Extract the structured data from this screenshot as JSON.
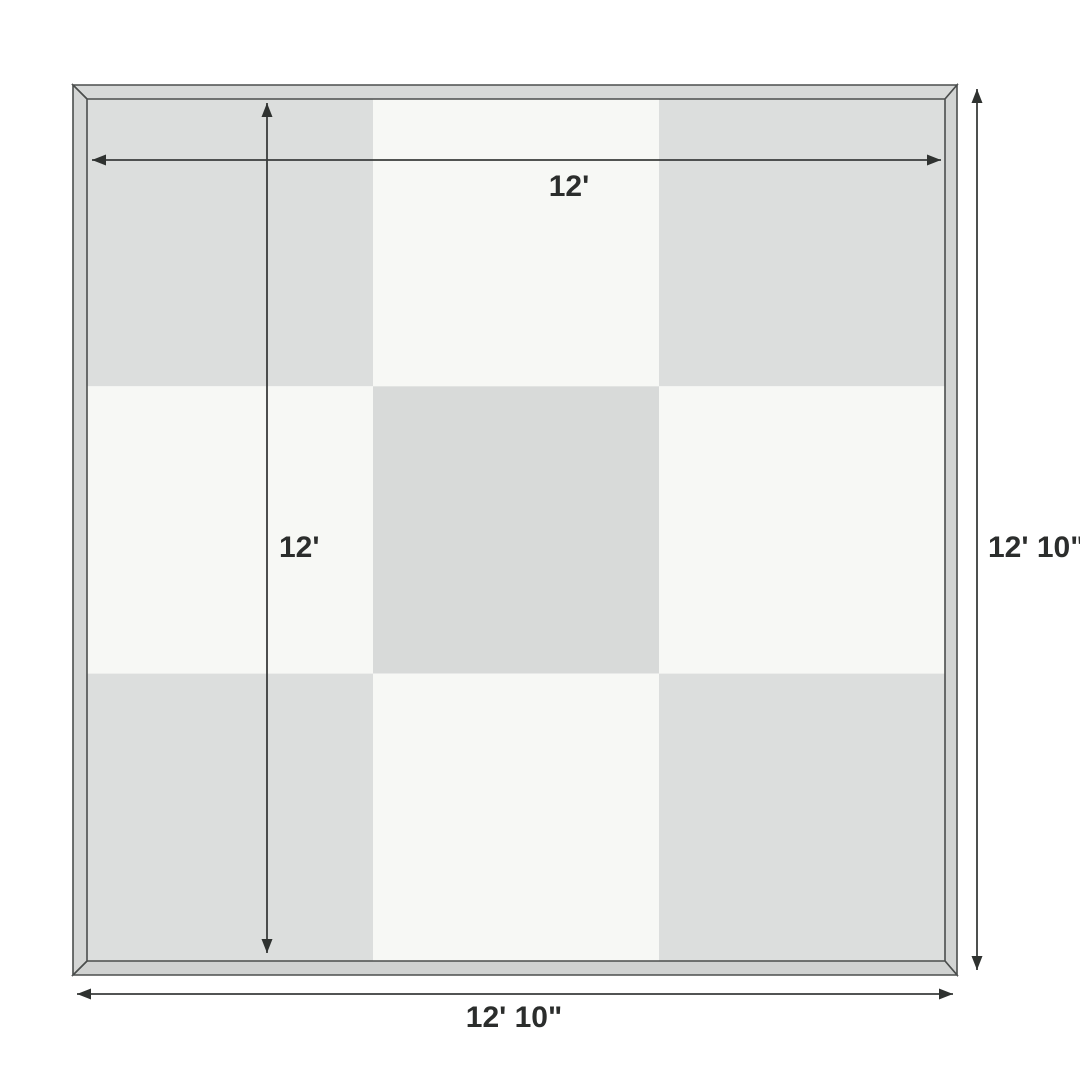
{
  "diagram": {
    "type": "product-dimension-diagram",
    "subject": "square framed mat with 3x3 checkerboard tile pattern and dimension arrows"
  },
  "labels": {
    "inner_width": "12'",
    "inner_height": "12'",
    "outer_height": "12' 10\"",
    "outer_width": "12' 10\""
  },
  "colors": {
    "background": "#ffffff",
    "tile_light": "#f7f8f5",
    "tile_gray": "#dcdedd",
    "tile_center": "#d8dad9",
    "frame_top": "#d7d9d8",
    "frame_right": "#d2d4d3",
    "frame_bottom": "#d0d2d1",
    "frame_left": "#d4d6d5",
    "frame_outline": "#4b4e4d",
    "dimension_line": "#3a3c3b",
    "label_text": "#2b2d2c"
  },
  "mat": {
    "grid": {
      "rows": 3,
      "cols": 3
    },
    "tiles": [
      {
        "row": 0,
        "col": 0,
        "fill": "#dcdedd"
      },
      {
        "row": 0,
        "col": 1,
        "fill": "#f7f8f5"
      },
      {
        "row": 0,
        "col": 2,
        "fill": "#dcdedd"
      },
      {
        "row": 1,
        "col": 0,
        "fill": "#f7f8f5"
      },
      {
        "row": 1,
        "col": 1,
        "fill": "#d8dad9"
      },
      {
        "row": 1,
        "col": 2,
        "fill": "#f7f8f5"
      },
      {
        "row": 2,
        "col": 0,
        "fill": "#dcdedd"
      },
      {
        "row": 2,
        "col": 1,
        "fill": "#f7f8f5"
      },
      {
        "row": 2,
        "col": 2,
        "fill": "#dcdedd"
      }
    ]
  }
}
